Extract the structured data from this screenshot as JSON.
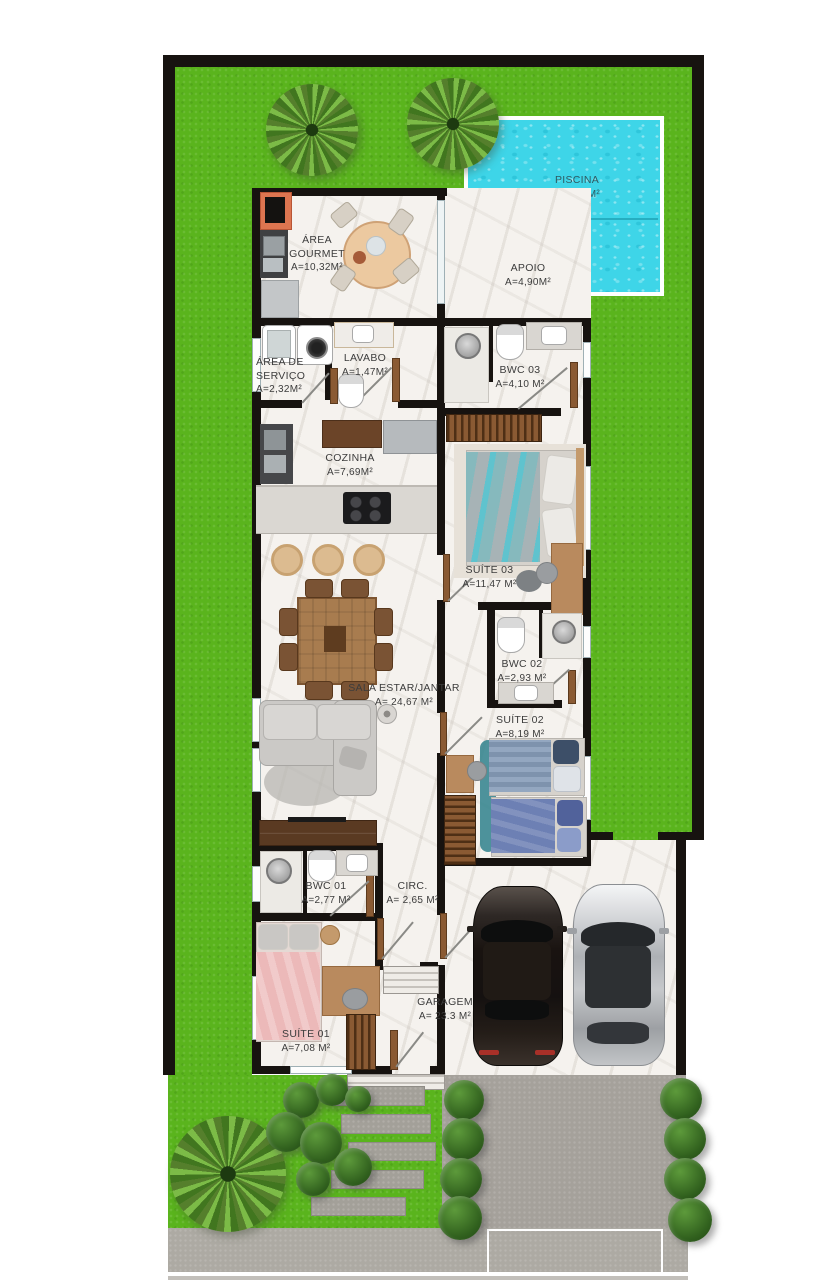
{
  "rooms": {
    "piscina": {
      "name": "PISCINA",
      "area": "A=9,30M²"
    },
    "area_gourmet": {
      "name": "ÁREA GOURMET",
      "area": "A=10,32M²"
    },
    "apoio": {
      "name": "APOIO",
      "area": "A=4,90M²"
    },
    "area_servico": {
      "name": "ÁREA DE SERVIÇO",
      "area": "A=2,32M²"
    },
    "lavabo": {
      "name": "LAVABO",
      "area": "A=1,47M²"
    },
    "bwc03": {
      "name": "BWC 03",
      "area": "A=4,10 M²"
    },
    "cozinha": {
      "name": "COZINHA",
      "area": "A=7,69M²"
    },
    "suite03": {
      "name": "SUÍTE 03",
      "area": "A=11,47 M²"
    },
    "bwc02": {
      "name": "BWC 02",
      "area": "A=2,93 M²"
    },
    "sala_estar_jantar": {
      "name": "SALA ESTAR/JANTAR",
      "area": "A= 24,67 M²"
    },
    "suite02": {
      "name": "SUÍTE 02",
      "area": "A=8,19 M²"
    },
    "bwc01": {
      "name": "BWC 01",
      "area": "A=2,77 M²"
    },
    "circ": {
      "name": "CIRC.",
      "area": "A= 2,65 M²"
    },
    "suite01": {
      "name": "SUÍTE 01",
      "area": "A=7,08 M²"
    },
    "garagem": {
      "name": "GARAGEM",
      "area": "A= 23.3 M²"
    }
  },
  "colors": {
    "lawn": "#5ab41d",
    "pool_water": "#3ed5e8",
    "pool_rim": "#ffffff",
    "wall": "#171310",
    "floor_marble": "#f5f2ee",
    "deck_wood": "#c08f60",
    "paving_gray": "#a5a19b",
    "grill_accent": "#dd7550",
    "bed_pink": "#ecb9b9",
    "bed_blue": "#6d80b4",
    "bed_teal": "#6fc6cf"
  }
}
